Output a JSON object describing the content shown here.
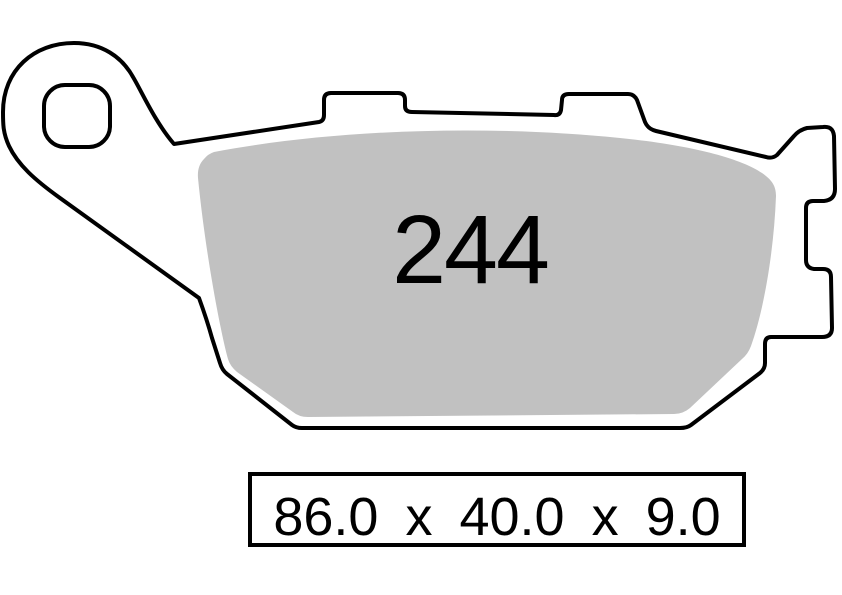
{
  "diagram": {
    "title": "brake pad profile drawing",
    "part_number": "244",
    "dimensions": "86.0 x 40.0 x 9.0",
    "colors": {
      "outline": "#000000",
      "backplate_fill": "#ffffff",
      "pad_fill": "#c1c1c1",
      "background": "#ffffff"
    }
  }
}
